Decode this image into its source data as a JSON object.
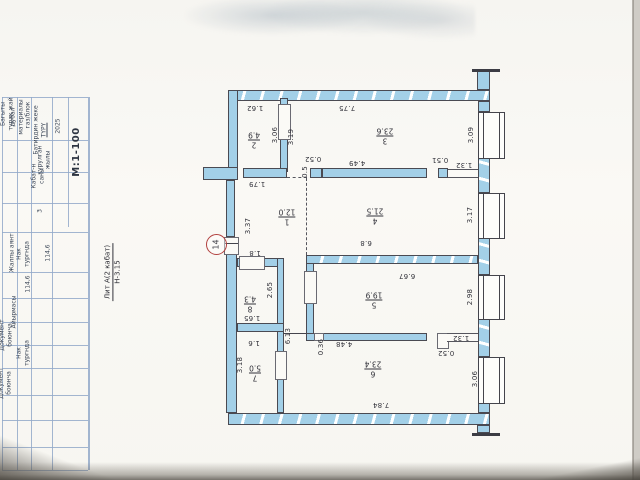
{
  "document": {
    "type": "technical passport floor plan sheet",
    "scale_label": "М:1-100",
    "litera": {
      "line1": "Лит А(2 кабат)",
      "line2": "Н-3.15"
    },
    "marker": {
      "text": "14"
    }
  },
  "table": {
    "labels": [
      {
        "t": "Багыты\nтурак жай",
        "x": 7,
        "y": 114
      },
      {
        "t": "дубал\nматериалы",
        "x": 17,
        "y": 117
      },
      {
        "t": "газ/блок",
        "x": 28,
        "y": 115
      },
      {
        "t": "Батирдин жеке\nТҮРҮ",
        "x": 40,
        "y": 130,
        "u": 1
      },
      {
        "t": "курулган\nжылы",
        "x": 44,
        "y": 160
      },
      {
        "t": "2025",
        "x": 58,
        "y": 126
      },
      {
        "t": "М:1-100",
        "x": 77,
        "y": 152,
        "big": true
      },
      {
        "t": "Кабат-н\nсаны",
        "x": 38,
        "y": 176
      },
      {
        "t": "3",
        "x": 40,
        "y": 211
      },
      {
        "t": "Жалпы аянт",
        "x": 12,
        "y": 253
      },
      {
        "t": "Нак\nтургнда",
        "x": 23,
        "y": 254
      },
      {
        "t": "114,6",
        "x": 48,
        "y": 253
      },
      {
        "t": "114,6",
        "x": 28,
        "y": 284
      },
      {
        "t": "Айырмасы",
        "x": 14,
        "y": 312
      },
      {
        "t": "Нак\nтургнда",
        "x": 23,
        "y": 353
      },
      {
        "t": "Документ\nбоюнча",
        "x": 6,
        "y": 335
      },
      {
        "t": "Документ\nбоюнча",
        "x": 5,
        "y": 383
      }
    ]
  },
  "plan": {
    "rooms": [
      {
        "n": "1",
        "a": "12.0",
        "x": 287,
        "y": 217
      },
      {
        "n": "2",
        "a": "4.9",
        "x": 254,
        "y": 140
      },
      {
        "n": "3",
        "a": "23.6",
        "x": 385,
        "y": 136
      },
      {
        "n": "4",
        "a": "21.5",
        "x": 375,
        "y": 216
      },
      {
        "n": "5",
        "a": "19.9",
        "x": 374,
        "y": 300
      },
      {
        "n": "6",
        "a": "23.4",
        "x": 373,
        "y": 369
      },
      {
        "n": "7",
        "a": "5.0",
        "x": 255,
        "y": 373
      },
      {
        "n": "8",
        "a": "4.3",
        "x": 250,
        "y": 304
      }
    ],
    "dims": [
      {
        "t": "1.62",
        "x": 255,
        "y": 108,
        "r": 180
      },
      {
        "t": "7.75",
        "x": 347,
        "y": 108,
        "r": 180
      },
      {
        "t": "3.06",
        "x": 275,
        "y": 135,
        "r": -90
      },
      {
        "t": "3.19",
        "x": 291,
        "y": 137,
        "r": -90
      },
      {
        "t": "3.09",
        "x": 471,
        "y": 135,
        "r": -90
      },
      {
        "t": "1.79",
        "x": 257,
        "y": 184,
        "r": 180
      },
      {
        "t": "0.52",
        "x": 313,
        "y": 159,
        "r": 180
      },
      {
        "t": "0.5",
        "x": 305,
        "y": 172,
        "r": -90
      },
      {
        "t": "4.49",
        "x": 357,
        "y": 163,
        "r": 180
      },
      {
        "t": "0.51",
        "x": 440,
        "y": 160,
        "r": 180
      },
      {
        "t": "1.32",
        "x": 464,
        "y": 165,
        "r": 180
      },
      {
        "t": "3.37",
        "x": 248,
        "y": 226,
        "r": -90
      },
      {
        "t": "3.17",
        "x": 470,
        "y": 215,
        "r": -90
      },
      {
        "t": "6.8",
        "x": 366,
        "y": 243,
        "r": 180
      },
      {
        "t": "1.8",
        "x": 255,
        "y": 253,
        "r": 180
      },
      {
        "t": "6.67",
        "x": 407,
        "y": 276,
        "r": 180
      },
      {
        "t": "2.65",
        "x": 270,
        "y": 290,
        "r": -90
      },
      {
        "t": "2.98",
        "x": 470,
        "y": 297,
        "r": -90
      },
      {
        "t": "1.65",
        "x": 252,
        "y": 318,
        "r": 180
      },
      {
        "t": "6.13",
        "x": 288,
        "y": 336,
        "r": -90
      },
      {
        "t": "0.36",
        "x": 321,
        "y": 347,
        "r": -90
      },
      {
        "t": "4.48",
        "x": 344,
        "y": 344,
        "r": 180
      },
      {
        "t": "1.32",
        "x": 461,
        "y": 338,
        "r": 180
      },
      {
        "t": "0.52",
        "x": 446,
        "y": 353,
        "r": 180
      },
      {
        "t": "1.6",
        "x": 254,
        "y": 343,
        "r": 180
      },
      {
        "t": "3.18",
        "x": 240,
        "y": 365,
        "r": -90
      },
      {
        "t": "7.84",
        "x": 381,
        "y": 405,
        "r": 180
      },
      {
        "t": "3.06",
        "x": 475,
        "y": 379,
        "r": -90
      }
    ]
  }
}
